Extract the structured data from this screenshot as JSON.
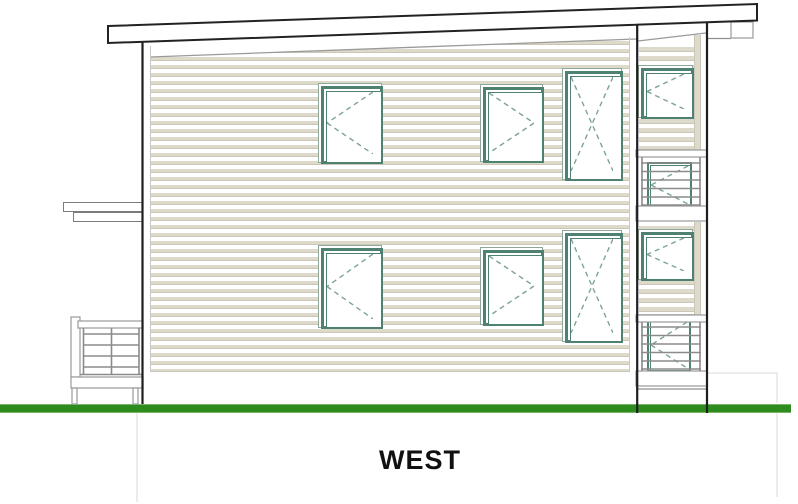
{
  "title": {
    "label": "WEST"
  },
  "colors": {
    "background": "#ffffff",
    "outline_dark": "#1e1e1e",
    "line_gray": "#8f8f8f",
    "line_light": "#c9c9c9",
    "line_faint": "#d8d8d8",
    "siding_beige": "#dedacb",
    "siding_shadow": "#cbc7b6",
    "frame_teal": "#4f8173",
    "frame_teal_light": "#8fa69a",
    "dash_teal": "#7da395",
    "railing_gray": "#8b8b8b",
    "band_stroke": "#9a9a9a",
    "grass_green": "#2e8b1e",
    "grass_edge": "#79b467",
    "text": "#111111"
  },
  "drawing": {
    "siding_areas": [
      {
        "id": "main-wall-siding",
        "x": 150,
        "y": 37,
        "w": 480,
        "h": 335,
        "period": 8,
        "beige": 3,
        "shadow": 1
      },
      {
        "id": "tower-siding-upper",
        "x": 639,
        "y": 43,
        "w": 55,
        "h": 107,
        "period": 9,
        "beige": 4,
        "shadow": 1
      },
      {
        "id": "tower-siding-lower",
        "x": 639,
        "y": 222,
        "w": 55,
        "h": 93,
        "period": 9,
        "beige": 4,
        "shadow": 1
      }
    ],
    "beige_strips": [
      {
        "id": "tower-trim-strip-upper",
        "x": 694,
        "y": 35,
        "w": 7,
        "h": 115
      },
      {
        "id": "tower-trim-strip-lower",
        "x": 694,
        "y": 222,
        "w": 7,
        "h": 93
      }
    ],
    "canopy_bars": [
      {
        "id": "entry-canopy-top",
        "x": 63,
        "y": 202,
        "w": 80,
        "h": 10
      },
      {
        "id": "entry-canopy-bottom",
        "x": 73,
        "y": 212,
        "w": 70,
        "h": 10
      }
    ],
    "grass": {
      "id": "grade-line",
      "x": 0,
      "y": 404,
      "w": 791,
      "h": 9
    },
    "windows": [
      {
        "id": "window-upper-left",
        "x": 318,
        "y": 83,
        "w": 64,
        "h": 80,
        "swing": "left",
        "style": "full"
      },
      {
        "id": "window-upper-middle",
        "x": 480,
        "y": 84,
        "w": 63,
        "h": 78,
        "swing": "right",
        "style": "full"
      },
      {
        "id": "window-upper-tall",
        "x": 562,
        "y": 68,
        "w": 60,
        "h": 112,
        "swing": "x",
        "style": "full"
      },
      {
        "id": "window-tower-upper",
        "x": 638,
        "y": 65,
        "w": 55,
        "h": 53,
        "swing": "left",
        "style": "full"
      },
      {
        "id": "window-balcony-upper",
        "x": 647,
        "y": 162,
        "w": 45,
        "h": 46,
        "swing": "left",
        "style": "thin"
      },
      {
        "id": "window-lower-left",
        "x": 318,
        "y": 245,
        "w": 64,
        "h": 83,
        "swing": "left",
        "style": "full"
      },
      {
        "id": "window-lower-middle",
        "x": 480,
        "y": 247,
        "w": 63,
        "h": 78,
        "swing": "right",
        "style": "full"
      },
      {
        "id": "window-lower-tall",
        "x": 562,
        "y": 230,
        "w": 60,
        "h": 112,
        "swing": "x",
        "style": "full"
      },
      {
        "id": "window-tower-lower",
        "x": 638,
        "y": 229,
        "w": 55,
        "h": 51,
        "swing": "left",
        "style": "full"
      },
      {
        "id": "window-balcony-lower",
        "x": 647,
        "y": 318,
        "w": 44,
        "h": 54,
        "swing": "left",
        "style": "thin"
      }
    ],
    "mask_polygons": [
      {
        "id": "wall-top-slope-mask",
        "points": [
          [
            148,
            35
          ],
          [
            639,
            35
          ],
          [
            639,
            39
          ],
          [
            148,
            57
          ]
        ]
      },
      {
        "id": "tower-top-slope-mask",
        "points": [
          [
            637,
            27
          ],
          [
            708,
            27
          ],
          [
            708,
            32
          ],
          [
            637,
            41
          ]
        ]
      }
    ],
    "diag_lines": [
      {
        "id": "wall-top-trim",
        "x1": 150,
        "y1": 57,
        "x2": 637,
        "y2": 39
      },
      {
        "id": "tower-top-trim",
        "x1": 638,
        "y1": 41,
        "x2": 706,
        "y2": 33
      }
    ],
    "trim_lines": [
      {
        "id": "left-corner-trim",
        "x1": 150.5,
        "y1": 46,
        "x2": 150.5,
        "y2": 372
      },
      {
        "id": "right-corner-trim",
        "x1": 629.5,
        "y1": 37,
        "x2": 629.5,
        "y2": 372
      }
    ],
    "white_bands": [
      {
        "id": "porch-post",
        "x": 71,
        "y": 317,
        "w": 9,
        "h": 60
      },
      {
        "id": "porch-top-rail",
        "x": 78,
        "y": 321,
        "w": 65,
        "h": 7
      },
      {
        "id": "porch-deck-band",
        "x": 71,
        "y": 377,
        "w": 72,
        "h": 11
      },
      {
        "id": "porch-sub-post-left",
        "x": 72,
        "y": 388,
        "w": 5,
        "h": 16
      },
      {
        "id": "porch-sub-post-right",
        "x": 133,
        "y": 388,
        "w": 5,
        "h": 16
      },
      {
        "id": "tower-top-rail-upper",
        "x": 636,
        "y": 150,
        "w": 71,
        "h": 7
      },
      {
        "id": "tower-deck-band-upper",
        "x": 636,
        "y": 206,
        "w": 71,
        "h": 15
      },
      {
        "id": "tower-top-rail-lower",
        "x": 636,
        "y": 315,
        "w": 71,
        "h": 7
      },
      {
        "id": "tower-deck-band-lower",
        "x": 636,
        "y": 371,
        "w": 71,
        "h": 15
      },
      {
        "id": "fascia-return-box",
        "x": 731,
        "y": 22,
        "w": 22,
        "h": 16
      }
    ],
    "railings": [
      {
        "id": "porch-railing",
        "segments": [
          [
            83.5,
            328,
            83.5,
            374
          ],
          [
            111.5,
            328,
            111.5,
            374
          ],
          [
            139,
            328,
            139,
            374
          ],
          [
            83.5,
            334,
            139,
            334
          ],
          [
            83.5,
            345,
            139,
            345
          ],
          [
            83.5,
            356,
            139,
            356
          ],
          [
            83.5,
            367,
            139,
            367
          ],
          [
            80,
            374.5,
            143,
            374.5
          ]
        ]
      },
      {
        "id": "balcony-railing-upper",
        "segments": [
          [
            642,
            157,
            642,
            206
          ],
          [
            700,
            157,
            700,
            206
          ],
          [
            641,
            163,
            701,
            163
          ],
          [
            641,
            171.5,
            701,
            171.5
          ],
          [
            641,
            180,
            701,
            180
          ],
          [
            641,
            188.5,
            701,
            188.5
          ],
          [
            641,
            197,
            701,
            197
          ],
          [
            641,
            205,
            701,
            205
          ]
        ]
      },
      {
        "id": "balcony-railing-lower",
        "segments": [
          [
            642,
            322,
            642,
            371
          ],
          [
            700,
            322,
            700,
            371
          ],
          [
            641,
            327,
            701,
            327
          ],
          [
            641,
            335.5,
            701,
            335.5
          ],
          [
            641,
            344,
            701,
            344
          ],
          [
            641,
            352.5,
            701,
            352.5
          ],
          [
            641,
            361,
            701,
            361
          ],
          [
            641,
            369,
            701,
            369
          ]
        ]
      }
    ],
    "gray_lines": [
      {
        "id": "fascia-underline",
        "x1": 708,
        "y1": 38.5,
        "x2": 731,
        "y2": 38.5
      },
      {
        "id": "tower-foundation-line",
        "x1": 637,
        "y1": 389,
        "x2": 706,
        "y2": 389
      }
    ],
    "faint_lines": [
      {
        "id": "below-grade-left",
        "x1": 137,
        "y1": 413,
        "x2": 137,
        "y2": 502
      },
      {
        "id": "stair-top-faint",
        "x1": 706,
        "y1": 373,
        "x2": 777,
        "y2": 373
      },
      {
        "id": "stair-side-faint-upper",
        "x1": 777,
        "y1": 373,
        "x2": 777,
        "y2": 403
      },
      {
        "id": "stair-side-faint-lower",
        "x1": 777,
        "y1": 413,
        "x2": 777,
        "y2": 497
      }
    ],
    "posts": [
      {
        "id": "left-wall-edge",
        "x1": 142.5,
        "y1": 41,
        "x2": 142.5,
        "y2": 404
      },
      {
        "id": "tower-post-left",
        "x1": 637.2,
        "y1": 22,
        "x2": 637.2,
        "y2": 413
      },
      {
        "id": "tower-post-right",
        "x1": 707,
        "y1": 21,
        "x2": 707,
        "y2": 413
      }
    ],
    "roof": {
      "id": "shed-roof",
      "points": [
        [
          108,
          26
        ],
        [
          757,
          4
        ],
        [
          757,
          20.5
        ],
        [
          108,
          43
        ]
      ]
    }
  }
}
